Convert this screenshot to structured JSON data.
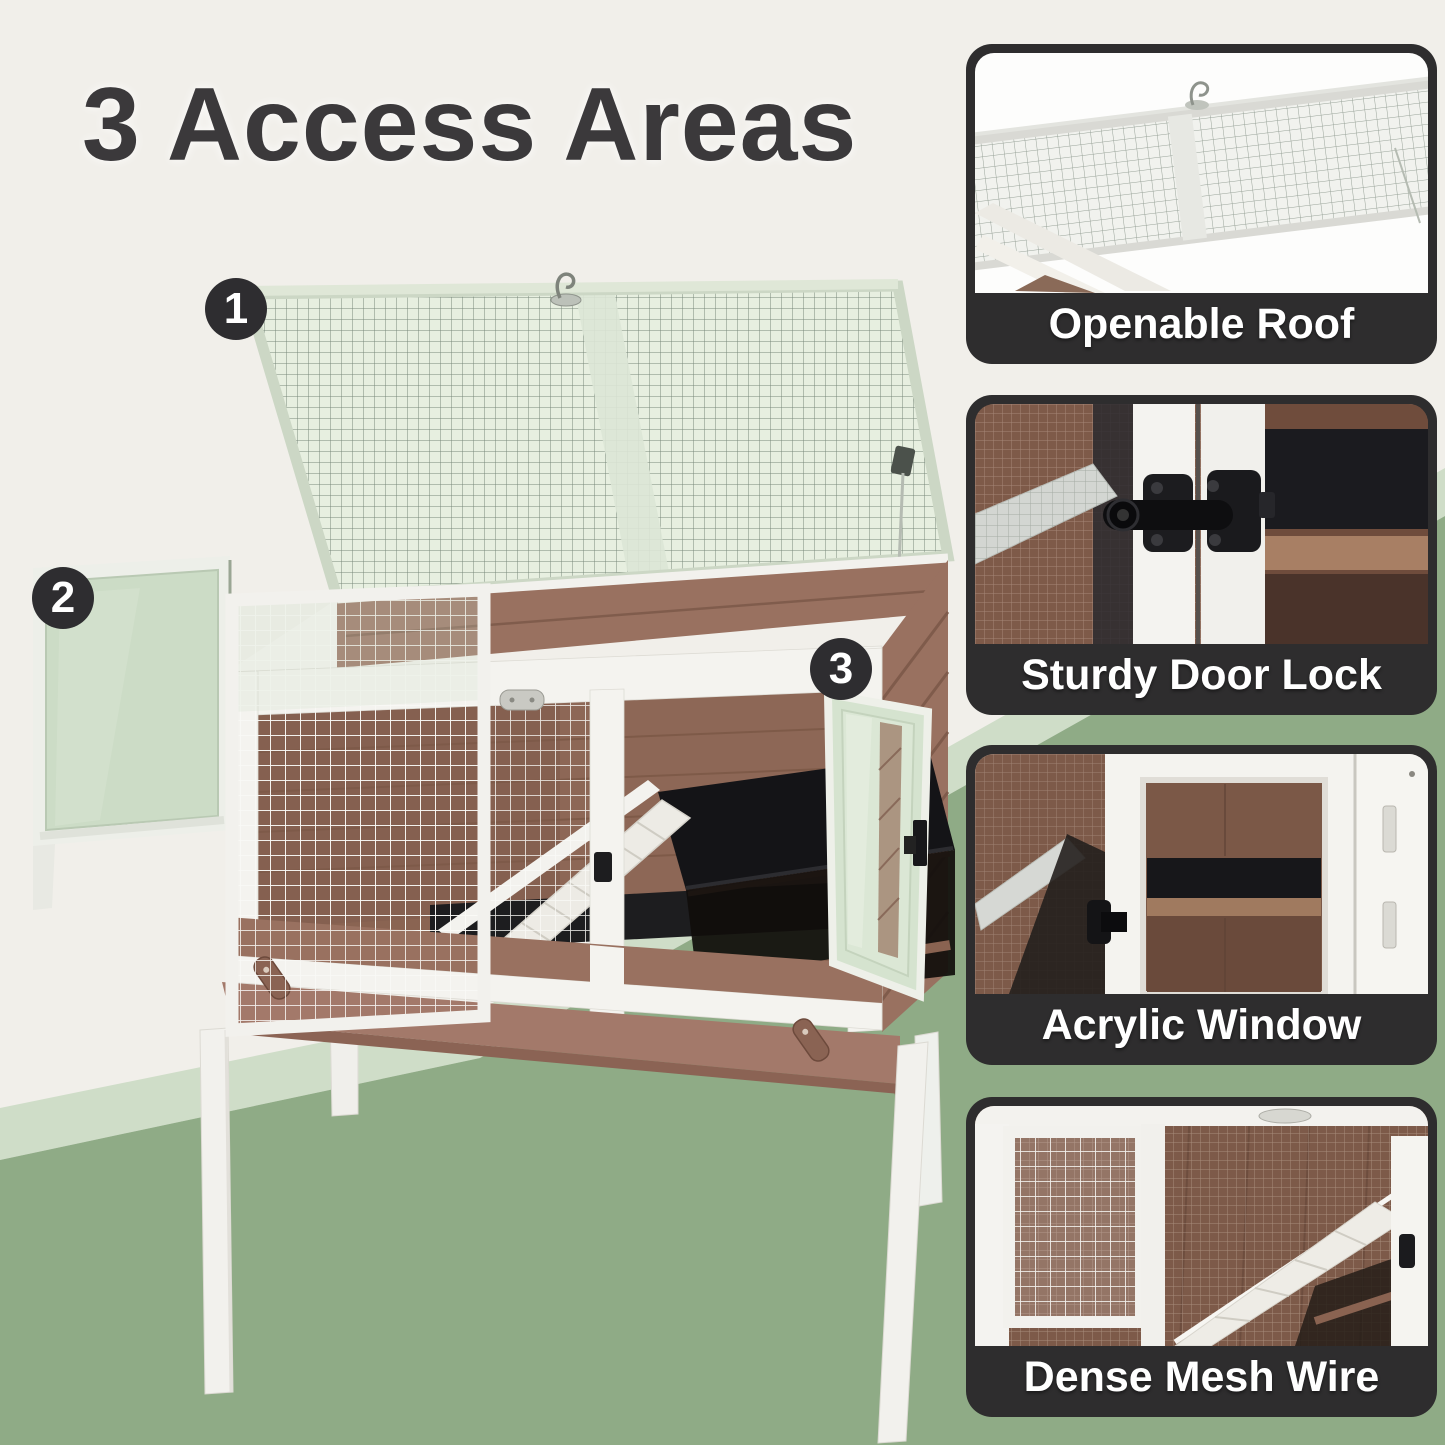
{
  "title": "3 Access Areas",
  "main_image": {
    "markers": [
      "1",
      "2",
      "3"
    ]
  },
  "features": [
    {
      "caption": "Openable Roof"
    },
    {
      "caption": "Sturdy Door Lock"
    },
    {
      "caption": "Acrylic Window"
    },
    {
      "caption": "Dense Mesh Wire"
    }
  ],
  "theme": {
    "bg-cream": "#f1efea",
    "band-light": "#cfddc8",
    "bg-green": "#8fab86",
    "caption-bar": "#2e2d2e",
    "caption-text": "#ffffff",
    "title-color": "#3b393b",
    "marker-bg": "#2e2d30",
    "marker-text": "#ffffff",
    "wood": "#997160",
    "wood-dark": "#7b5848",
    "frame-white": "#f4f3ef",
    "roof-green": "#e6eedf",
    "acrylic-green": "#cbdcc5",
    "floor-black": "#1d1d1f"
  }
}
